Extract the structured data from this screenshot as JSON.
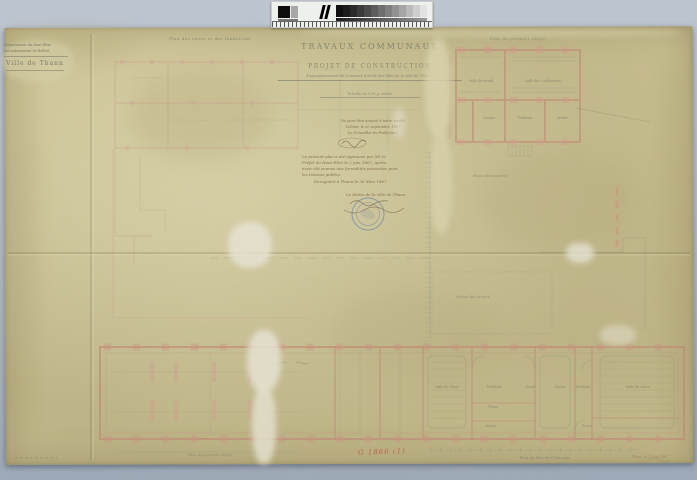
{
  "colors": {
    "backdrop": "#b4bdc9",
    "paper": "#cbc294",
    "wall_pink": "#c08673",
    "ink_gray": "#82856d",
    "ink_brown": "#6b5136",
    "stamp_blue": "#5b79b8",
    "red_mark": "#b5473c"
  },
  "archive_label": {
    "line1": "Département du Haut-Rhin",
    "line2": "Arrondissement de Belfort",
    "city": "Ville de Thann"
  },
  "title_block": {
    "title": "TRAVAUX COMMUNAUX",
    "subtitle": "PROJET DE CONSTRUCTION",
    "object_line": "d'agrandissement de la maison d'école des filles de la ville de THANN",
    "scale_note": "Échelle de 0,01 p. mètre"
  },
  "visa_block": {
    "line1": "Vu pour être annexé à notre arrêté",
    "line2": "Colmar, le 20 septembre 1867",
    "line3": "Le Conseiller de Préfecture"
  },
  "approval_block": {
    "line1": "Le présent plan a été approuvé par Mr le",
    "line2": "Préfet du Haut-Rhin le 2 juin 1867, après",
    "line3": "avoir été soumis aux formalités prescrites pour",
    "line4": "les travaux publics.",
    "registered": "Enregistré à Thann le 26 8bre 1867",
    "signer": "Le Maire de la ville de Thann"
  },
  "plans": {
    "foundations": {
      "caption": "Plan des caves et des fondations"
    },
    "first_floor": {
      "caption": "Plan du premier étage",
      "rooms": [
        "Salle de travail",
        "Salle des Conférences",
        "Cuisine",
        "Vestibule",
        "Atelier"
      ]
    },
    "site": {
      "labels": [
        "Place découverte",
        "Préau découvert"
      ]
    },
    "ground_floor": {
      "caption": "Plan du Rez-de-Chaussée",
      "caption_left": "Plan du premier étage",
      "rooms": [
        "Salle de classe",
        "Vestibule",
        "Classe",
        "Classe",
        "Vestibule",
        "Salle de classe"
      ],
      "small_rooms": [
        "Préau",
        "Bûcher",
        "Préau"
      ]
    }
  },
  "marks": {
    "inventory_red": "G 1866 (1)",
    "corner_note": "Thann, le 10 mai 1867"
  }
}
